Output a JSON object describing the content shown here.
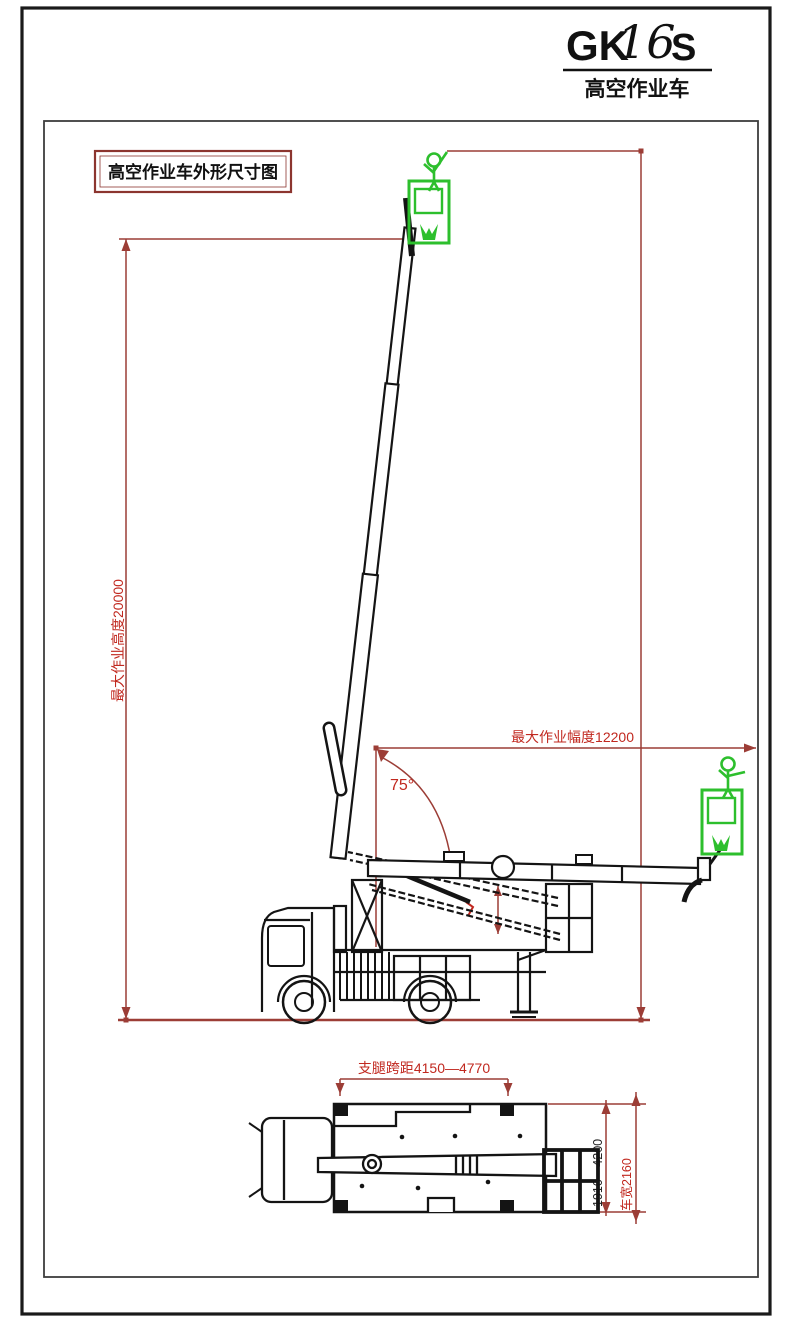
{
  "title": {
    "model_prefix": "GK",
    "model_digits": "16",
    "model_suffix": "S",
    "subtitle": "高空作业车"
  },
  "caption": {
    "text": "高空作业车外形尺寸图"
  },
  "dimensions": {
    "max_working_height": "最大作业高度20000",
    "max_working_radius": "最大作业幅度12200",
    "boom_angle": "75°",
    "outrigger_span_longitudinal": "支腿跨距4150—4770",
    "outrigger_span_transverse": "1910—4200",
    "vehicle_width": "车宽2160"
  },
  "colors": {
    "dimension_line": "#9c3d36",
    "dimension_text": "#c1281f",
    "drawing_line": "#141414",
    "basket_green": "#2dbf2d"
  }
}
